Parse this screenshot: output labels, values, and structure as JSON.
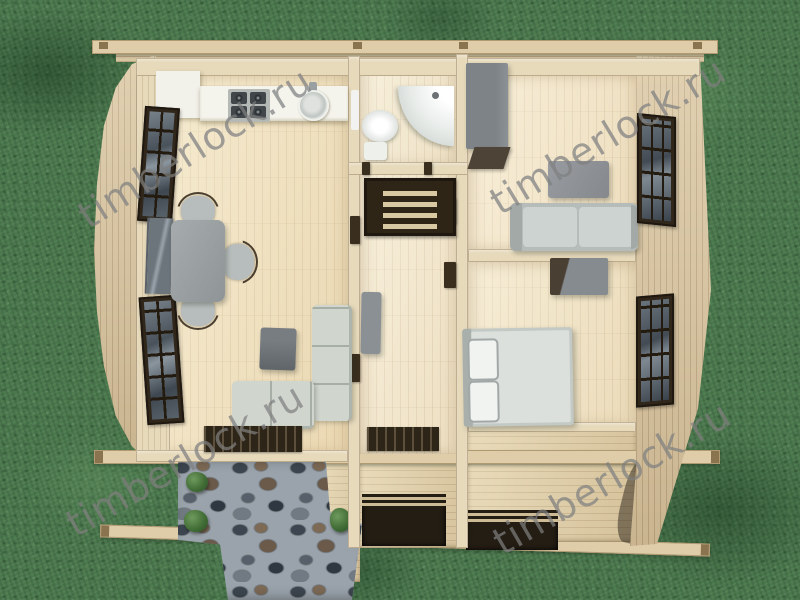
{
  "watermark": {
    "text": "timberlock.ru",
    "color": "#969490"
  },
  "palette": {
    "grass": "#4c784e",
    "stone_grout": "#9aa3ab",
    "wood_floor": "#efe0bc",
    "wood_wall": "#e7dabb",
    "wood_roof": "#d5c29e",
    "wood_deck": "#e0cfa8",
    "window_frame": "#30261a",
    "furniture_gray": "#9aa0a2",
    "fixture_white": "#f5f4ec"
  },
  "scene": {
    "type": "3d-top-down-floor-plan-render",
    "rooms": [
      "kitchen-living-room",
      "hallway",
      "bathroom",
      "bedroom-upper",
      "bedroom-lower",
      "terrace"
    ],
    "objects": [
      "fridge",
      "kitchen-counter",
      "gas-stove",
      "round-sink",
      "dining-table",
      "dining-chairs",
      "wall-tv",
      "corner-sofa",
      "tv-stand",
      "lattice-windows",
      "toilet",
      "corner-shower",
      "staircase",
      "doormats",
      "wardrobe",
      "desk",
      "two-seat-sofa",
      "dark-cabinet",
      "double-bed",
      "stone-path",
      "bushes",
      "support-beams",
      "ridge-beam"
    ]
  }
}
